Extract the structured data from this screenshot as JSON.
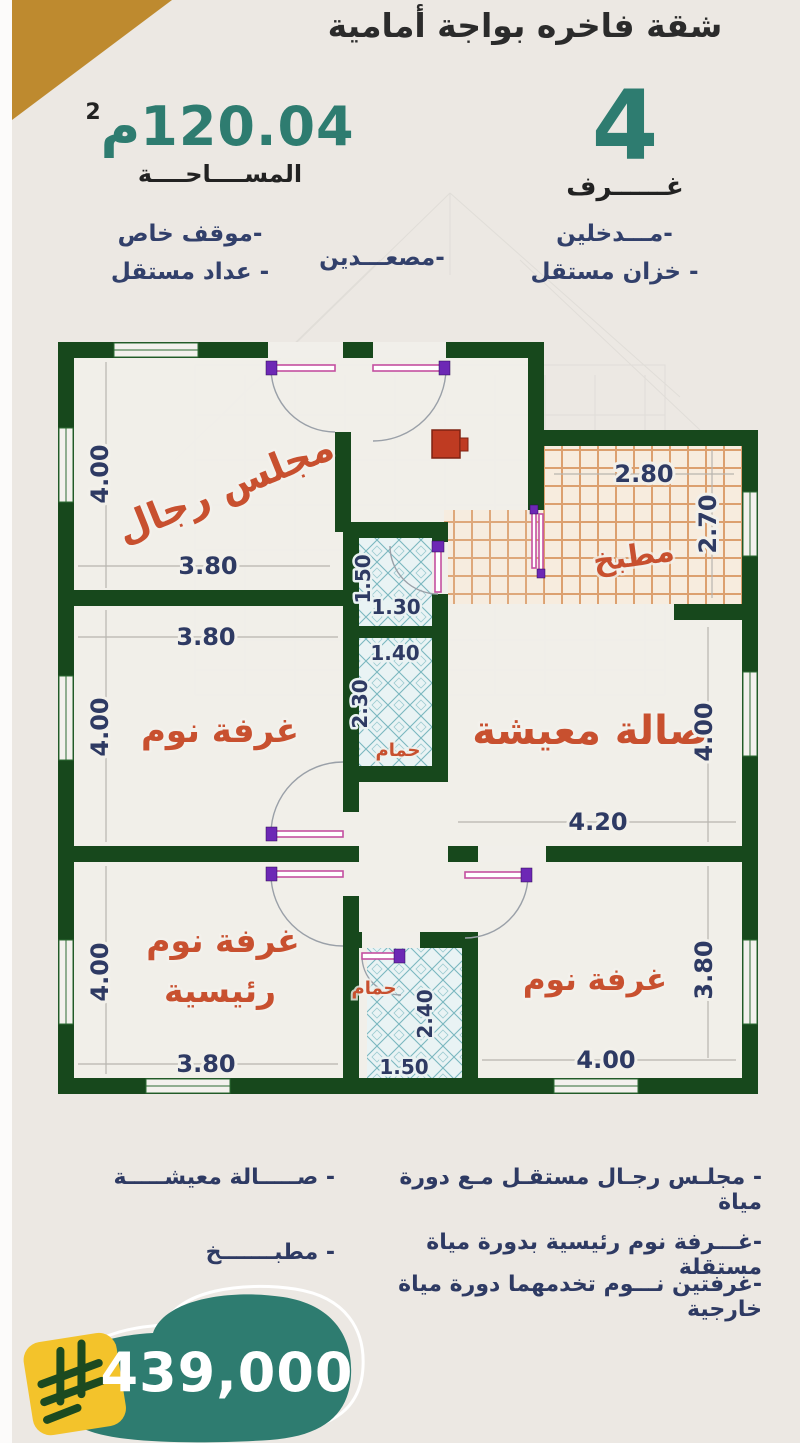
{
  "header": {
    "title": "شقة فاخره بواجة أمامية",
    "area_value": "120.04",
    "area_unit": "م",
    "area_sup": "2",
    "area_label": "المســــاحــــة",
    "rooms_count": "4",
    "rooms_label": "غــــــرف"
  },
  "features": {
    "parking": "-موقف خاص",
    "meter": "- عداد مستقل",
    "elevators": "-مصعـــدين",
    "entrances": "-مـــدخلين",
    "tank": "- خزان مستقل"
  },
  "plan": {
    "majlis": {
      "label": "مجلس رجال",
      "w": "3.80",
      "h": "4.00"
    },
    "kitchen": {
      "label": "مطبخ",
      "w": "2.80",
      "h": "2.70"
    },
    "wc": {
      "w": "1.30",
      "h": "1.50"
    },
    "bedroom1": {
      "label": "غرفة نوم",
      "w": "3.80",
      "h": "4.00"
    },
    "bath1": {
      "label": "حمام",
      "w": "1.40",
      "h": "2.30"
    },
    "living": {
      "label": "صالة معيشة",
      "w": "4.20",
      "h": "4.00"
    },
    "master": {
      "label1": "غرفة نوم",
      "label2": "رئيسية",
      "w": "3.80",
      "h": "4.00"
    },
    "bath2": {
      "label": "حمام",
      "w": "1.50",
      "h": "2.40"
    },
    "bedroom2": {
      "label": "غرفة نوم",
      "w": "4.00",
      "h": "3.80"
    }
  },
  "details": {
    "right": [
      "- مجلـس رجـال مستقـل مـع دورة مياة",
      "-غـــرفة نوم رئيسية بدورة مياة مستقلة",
      "-غرفتين نـــوم تخدمهما دورة مياة خارجية"
    ],
    "left": [
      "- صـــــالة معيشـــــة",
      "- مطبـــــــخ"
    ]
  },
  "price": {
    "value": "439,000"
  },
  "colors": {
    "teal": "#2E7C70",
    "gold": "#BE8A2F",
    "navy": "#32406B",
    "wall_green": "#17481C",
    "label_red": "#C8502F",
    "badge_yellow": "#F3C32B"
  }
}
